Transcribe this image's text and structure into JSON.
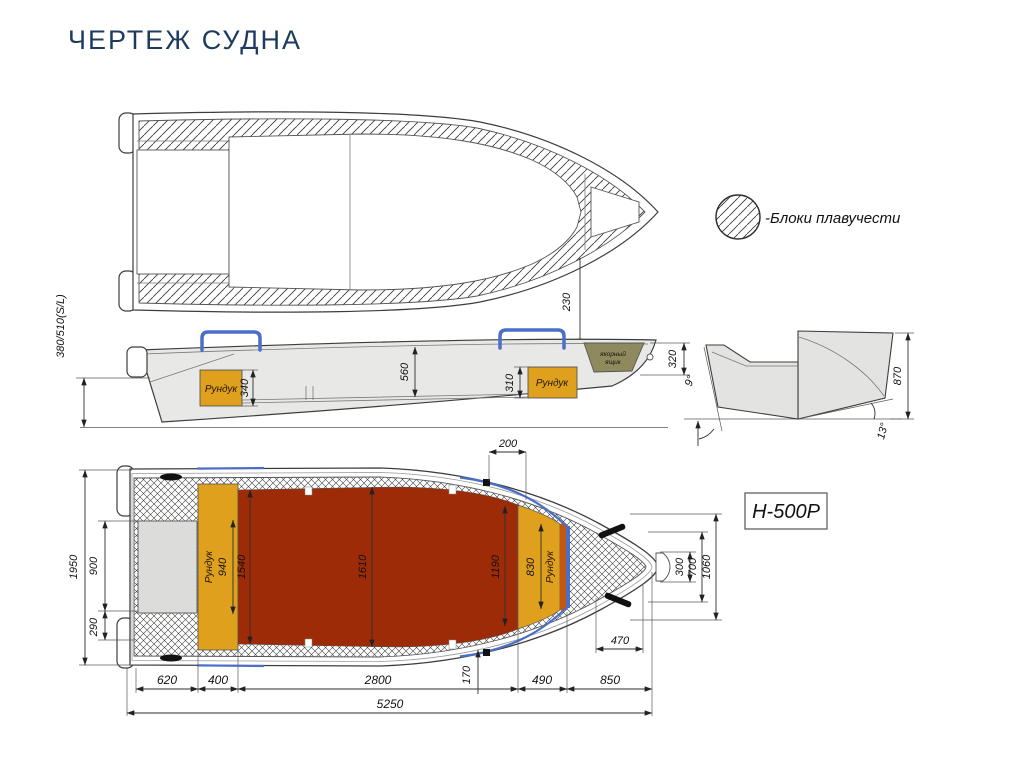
{
  "title": "ЧЕРТЕЖ СУДНА",
  "legend": {
    "label": "-Блоки плавучести"
  },
  "model_badge": {
    "label": "Н-500Р"
  },
  "colors": {
    "title_navy": "#1d3b5e",
    "deck_red": "#9e2b08",
    "runduk_orange": "#dfa01d",
    "runduk_orange_dark": "#c2590e",
    "accent_blue": "#4a6fc7",
    "anchor_olive": "#8f8a5e",
    "hull_gray": "#e8e8e6",
    "line": "#3d3d3d"
  },
  "top_view": {
    "dims": {
      "d230": "230"
    }
  },
  "side_view": {
    "labels": {
      "runduk_aft": "Рундук",
      "runduk_fore": "Рундук",
      "anchor_line1": "якорный",
      "anchor_line2": "ящик"
    },
    "dims": {
      "freeboard": "380/510(S/L)",
      "d560": "560",
      "d340": "340",
      "d310": "310",
      "d320": "320"
    }
  },
  "section_view": {
    "dims": {
      "d870": "870",
      "a9": "9°",
      "a13": "13°"
    }
  },
  "bottom_view": {
    "labels": {
      "runduk_stern": "Рундук",
      "runduk_bow": "Рундук"
    },
    "dims": {
      "d1950": "1950",
      "d900": "900",
      "d290": "290",
      "d940": "940",
      "d1540": "1540",
      "d1610": "1610",
      "d1190": "1190",
      "d830": "830",
      "d300": "300",
      "d700": "700",
      "d1060": "1060",
      "d200": "200",
      "d470": "470",
      "d170": "170"
    }
  },
  "length_chain": {
    "d620": "620",
    "d400": "400",
    "d2800": "2800",
    "d490": "490",
    "d850": "850",
    "total": "5250"
  }
}
